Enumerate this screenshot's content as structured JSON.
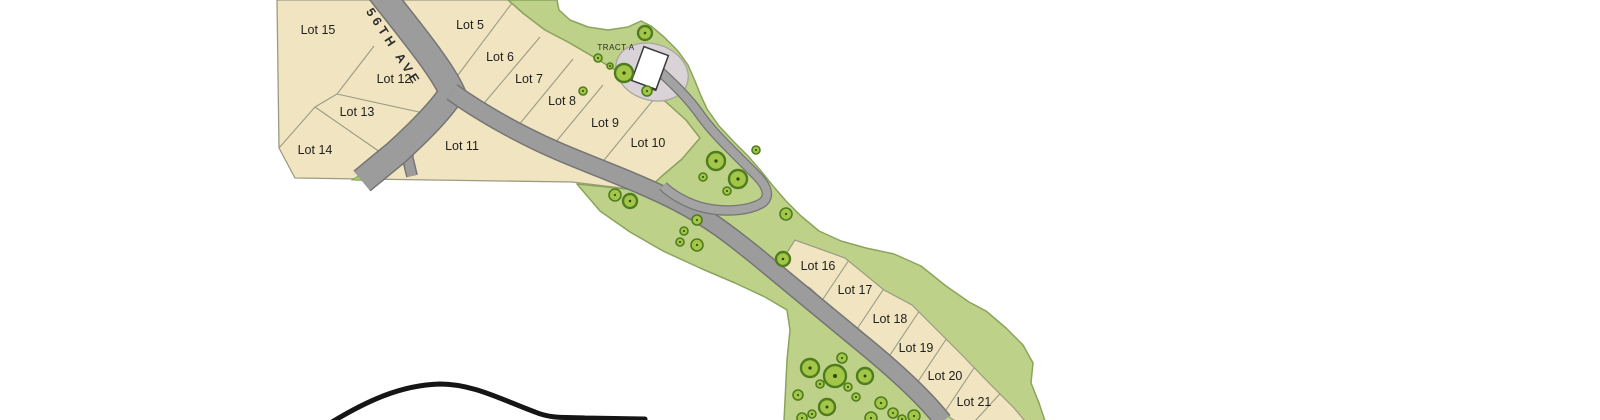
{
  "map": {
    "street_label": "W 56TH AVE",
    "tract_label": "TRACT A",
    "colors": {
      "background": "#ffffff",
      "parcel_fill": "#f0e5c0",
      "parcel_stroke": "#9b9b84",
      "green_fill": "#bdd288",
      "green_stroke": "#8aa45c",
      "road_fill": "#9c9c9c",
      "road_edge": "#757575",
      "lane_fill": "#a3a3a3",
      "pad_fill": "#d9d3d7",
      "pad_stroke": "#a9a99f",
      "building_fill": "#ffffff",
      "building_stroke": "#3c3c3c",
      "tree_fill": "#a4c648",
      "tree_stroke": "#4f7c1e",
      "tree_dot": "#274a08",
      "triangle_fill": "#a2cb62",
      "curve_color": "#151515"
    },
    "lot_labels": [
      {
        "text": "Lot 15",
        "x": 318,
        "y": 30
      },
      {
        "text": "Lot 5",
        "x": 470,
        "y": 25
      },
      {
        "text": "Lot 6",
        "x": 500,
        "y": 57
      },
      {
        "text": "Lot 7",
        "x": 529,
        "y": 79
      },
      {
        "text": "Lot 8",
        "x": 562,
        "y": 101
      },
      {
        "text": "Lot 9",
        "x": 605,
        "y": 123
      },
      {
        "text": "Lot 10",
        "x": 648,
        "y": 143
      },
      {
        "text": "Lot 11",
        "x": 462,
        "y": 146
      },
      {
        "text": "Lot 12",
        "x": 394,
        "y": 79
      },
      {
        "text": "Lot 13",
        "x": 357,
        "y": 112
      },
      {
        "text": "Lot 14",
        "x": 315,
        "y": 150
      },
      {
        "text": "Lot 16",
        "x": 818,
        "y": 266
      },
      {
        "text": "Lot 17",
        "x": 855,
        "y": 290
      },
      {
        "text": "Lot 18",
        "x": 890,
        "y": 319
      },
      {
        "text": "Lot 19",
        "x": 916,
        "y": 348
      },
      {
        "text": "Lot 20",
        "x": 945,
        "y": 376
      },
      {
        "text": "Lot 21",
        "x": 974,
        "y": 402
      }
    ],
    "street_label_pos": {
      "x": 353,
      "y": -8,
      "rot": 57,
      "spacing": 4
    },
    "tract_label_pos": {
      "x": 616,
      "y": 50
    },
    "parcel_block": [
      [
        277,
        0
      ],
      [
        508,
        0
      ],
      [
        524,
        14
      ],
      [
        545,
        30
      ],
      [
        568,
        42
      ],
      [
        592,
        56
      ],
      [
        617,
        71
      ],
      [
        642,
        86
      ],
      [
        666,
        102
      ],
      [
        686,
        120
      ],
      [
        700,
        138
      ],
      [
        682,
        159
      ],
      [
        662,
        176
      ],
      [
        646,
        191
      ],
      [
        572,
        182
      ],
      [
        295,
        178
      ],
      [
        279,
        148
      ]
    ],
    "green_corridor": [
      [
        508,
        0
      ],
      [
        557,
        0
      ],
      [
        559,
        10
      ],
      [
        570,
        20
      ],
      [
        588,
        27
      ],
      [
        608,
        30
      ],
      [
        628,
        27
      ],
      [
        641,
        21
      ],
      [
        651,
        26
      ],
      [
        664,
        37
      ],
      [
        678,
        51
      ],
      [
        688,
        65
      ],
      [
        695,
        81
      ],
      [
        701,
        96
      ],
      [
        707,
        109
      ],
      [
        719,
        126
      ],
      [
        733,
        141
      ],
      [
        748,
        156
      ],
      [
        761,
        171
      ],
      [
        773,
        186
      ],
      [
        786,
        201
      ],
      [
        801,
        216
      ],
      [
        819,
        231
      ],
      [
        841,
        241
      ],
      [
        866,
        248
      ],
      [
        894,
        254
      ],
      [
        921,
        266
      ],
      [
        946,
        286
      ],
      [
        969,
        302
      ],
      [
        986,
        311
      ],
      [
        1006,
        328
      ],
      [
        1023,
        345
      ],
      [
        1033,
        363
      ],
      [
        1031,
        383
      ],
      [
        1039,
        403
      ],
      [
        1045,
        421
      ],
      [
        784,
        421
      ],
      [
        787,
        360
      ],
      [
        790,
        330
      ],
      [
        787,
        310
      ],
      [
        765,
        297
      ],
      [
        735,
        283
      ],
      [
        700,
        268
      ],
      [
        663,
        251
      ],
      [
        630,
        232
      ],
      [
        600,
        211
      ],
      [
        577,
        184
      ],
      [
        646,
        191
      ],
      [
        662,
        176
      ],
      [
        682,
        159
      ],
      [
        700,
        138
      ],
      [
        686,
        120
      ],
      [
        666,
        102
      ],
      [
        642,
        86
      ],
      [
        617,
        71
      ],
      [
        592,
        56
      ],
      [
        568,
        42
      ],
      [
        545,
        30
      ],
      [
        524,
        14
      ]
    ],
    "lot_strip": [
      [
        772,
        276
      ],
      [
        795,
        240
      ],
      [
        845,
        258
      ],
      [
        884,
        290
      ],
      [
        912,
        305
      ],
      [
        935,
        328
      ],
      [
        962,
        355
      ],
      [
        988,
        382
      ],
      [
        1014,
        408
      ],
      [
        1025,
        421
      ],
      [
        955,
        421
      ],
      [
        940,
        410
      ],
      [
        920,
        392
      ],
      [
        898,
        371
      ],
      [
        876,
        350
      ],
      [
        854,
        330
      ],
      [
        832,
        309
      ],
      [
        810,
        288
      ],
      [
        790,
        277
      ]
    ],
    "green_triangle": [
      [
        352,
        180
      ],
      [
        372,
        167
      ],
      [
        375,
        181
      ]
    ],
    "block_lines": [
      [
        452,
        83,
        512,
        3
      ],
      [
        480,
        108,
        540,
        37
      ],
      [
        513,
        132,
        573,
        59
      ],
      [
        545,
        155,
        603,
        85
      ],
      [
        600,
        165,
        654,
        99
      ],
      [
        374,
        46,
        337,
        94
      ],
      [
        337,
        94,
        315,
        107
      ],
      [
        315,
        107,
        279,
        148
      ],
      [
        337,
        94,
        419,
        112
      ],
      [
        315,
        107,
        380,
        152
      ]
    ],
    "strip_lines": [
      [
        819,
        305,
        855,
        251
      ],
      [
        855,
        332,
        891,
        278
      ],
      [
        886,
        361,
        922,
        307
      ],
      [
        913,
        389,
        949,
        335
      ],
      [
        942,
        416,
        978,
        362
      ],
      [
        975,
        421,
        1008,
        385
      ]
    ],
    "roads": {
      "avenue": {
        "path": "M 372,-18 C 408,28 440,66 452,92 C 443,108 418,133 396,153 L 362,181",
        "width": 24
      },
      "main": {
        "path": "M 452,92 C 480,112 520,135 560,152 C 600,169 640,183 677,202 C 710,219 730,235 755,255 L 870,350 C 900,375 925,398 943,421",
        "width": 16
      },
      "lane": {
        "path": "M 656,68 C 672,82 690,100 701,116 C 716,137 742,160 757,176 C 768,187 770,197 762,203 C 750,210 728,213 705,208 C 687,204 671,194 663,186",
        "width": 8
      },
      "stubs": [
        {
          "path": "M 391,151 L 411,161",
          "width": 11
        },
        {
          "path": "M 407,155 L 412,176",
          "width": 9
        }
      ]
    },
    "tract_pad": {
      "x": 652,
      "y": 72,
      "rx": 37,
      "ry": 28,
      "rot": 18
    },
    "tract_building": {
      "x": 650,
      "y": 68,
      "rot": 20,
      "w": 26,
      "h": 36,
      "tail_w": 12,
      "tail_h": 11
    },
    "boundary_curve": {
      "path": "M 332,422 C 365,402 400,385 440,384 C 472,384 498,398 535,412 C 552,419 565,417 585,418 L 645,419",
      "width": 5
    },
    "trees": [
      [
        598,
        58,
        4
      ],
      [
        610,
        66,
        3
      ],
      [
        624,
        73,
        9
      ],
      [
        645,
        33,
        7
      ],
      [
        583,
        91,
        4
      ],
      [
        647,
        91,
        5
      ],
      [
        756,
        150,
        4
      ],
      [
        716,
        161,
        9
      ],
      [
        703,
        177,
        4
      ],
      [
        738,
        179,
        9
      ],
      [
        727,
        191,
        4
      ],
      [
        615,
        195,
        6
      ],
      [
        630,
        201,
        7
      ],
      [
        697,
        220,
        5
      ],
      [
        684,
        231,
        4
      ],
      [
        786,
        214,
        6
      ],
      [
        680,
        242,
        4
      ],
      [
        697,
        245,
        6
      ],
      [
        783,
        259,
        7
      ],
      [
        842,
        358,
        5
      ],
      [
        810,
        368,
        9
      ],
      [
        835,
        376,
        11
      ],
      [
        865,
        376,
        8
      ],
      [
        820,
        384,
        4
      ],
      [
        848,
        387,
        4
      ],
      [
        798,
        395,
        5
      ],
      [
        856,
        397,
        4
      ],
      [
        881,
        403,
        6
      ],
      [
        827,
        407,
        8
      ],
      [
        893,
        413,
        5
      ],
      [
        812,
        414,
        4
      ],
      [
        914,
        416,
        6
      ],
      [
        871,
        418,
        6
      ],
      [
        802,
        418,
        5
      ],
      [
        902,
        419,
        4
      ]
    ]
  }
}
